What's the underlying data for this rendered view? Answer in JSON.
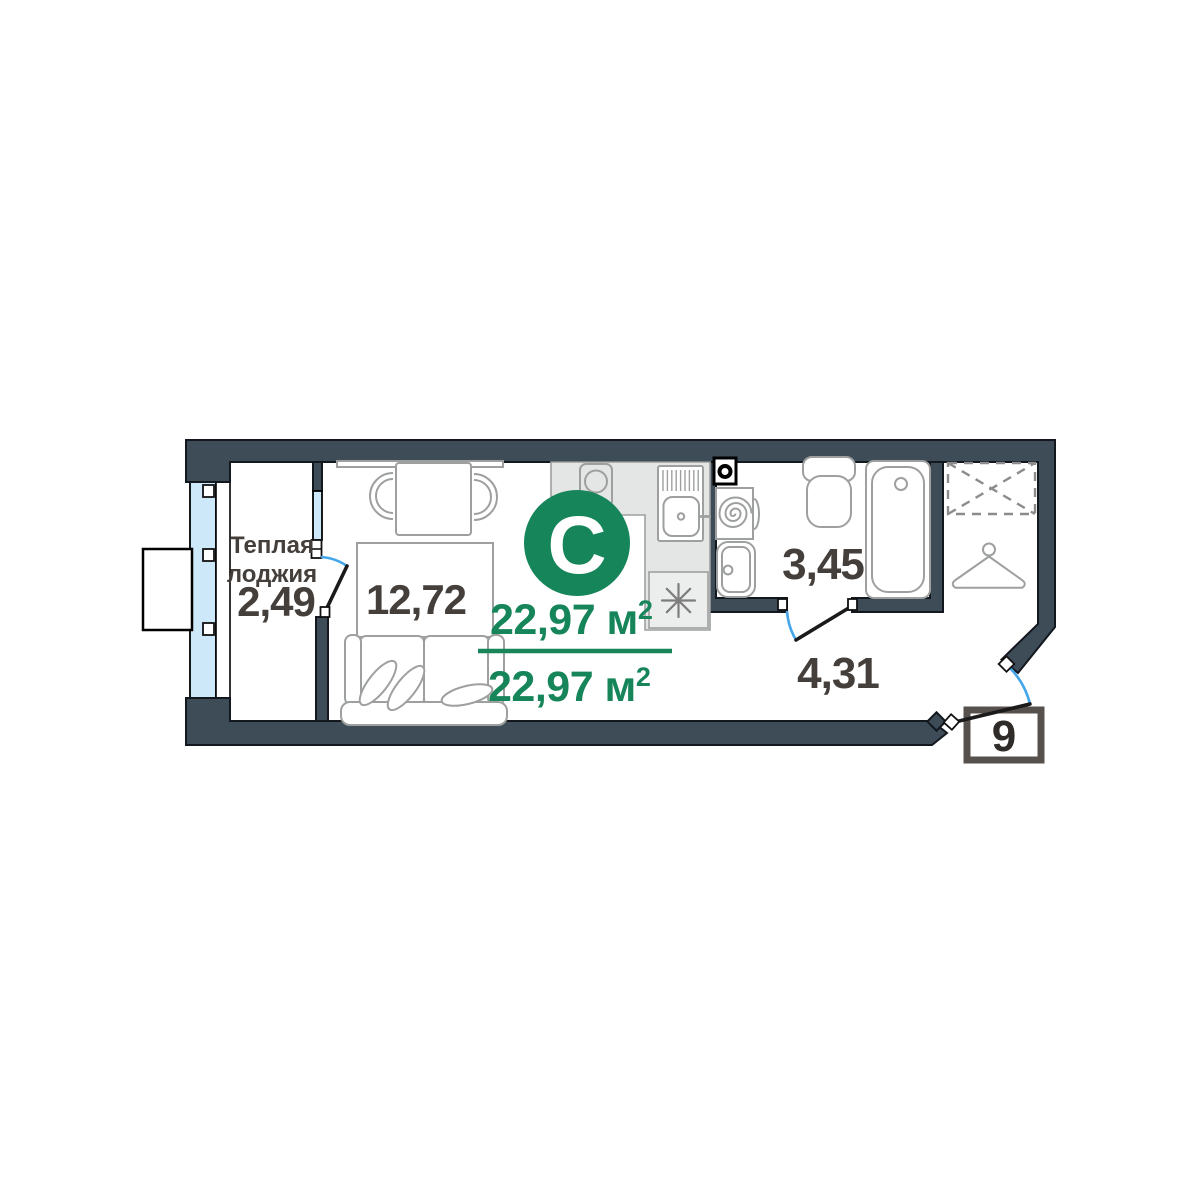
{
  "floor_plan": {
    "type_badge": "С",
    "area_summary": {
      "top_value": "22,97 м",
      "top_sup": "2",
      "bottom_value": "22,97 м",
      "bottom_sup": "2"
    },
    "rooms": {
      "loggia": {
        "label_line1": "Теплая",
        "label_line2": "лоджия",
        "area": "2,49"
      },
      "living_room": {
        "area": "12,72"
      },
      "bathroom": {
        "area": "3,45"
      },
      "hallway": {
        "area": "4,31"
      }
    },
    "apartment_number": "9",
    "colors": {
      "accent_green": "#17855A",
      "wall": "#3E4C58",
      "window_glass": "#CDE9F9",
      "door_swing": "#44A6E9"
    },
    "icons": {
      "fixtures": [
        "stove-icon",
        "kitchen-sink-icon",
        "fridge-snowflake-icon",
        "ventilation-icon",
        "washing-machine-icon",
        "bathroom-sink-icon",
        "toilet-icon",
        "bathtub-icon",
        "wardrobe-icon",
        "hanger-icon",
        "dining-table",
        "chair-icon",
        "bed",
        "sofa"
      ]
    }
  }
}
